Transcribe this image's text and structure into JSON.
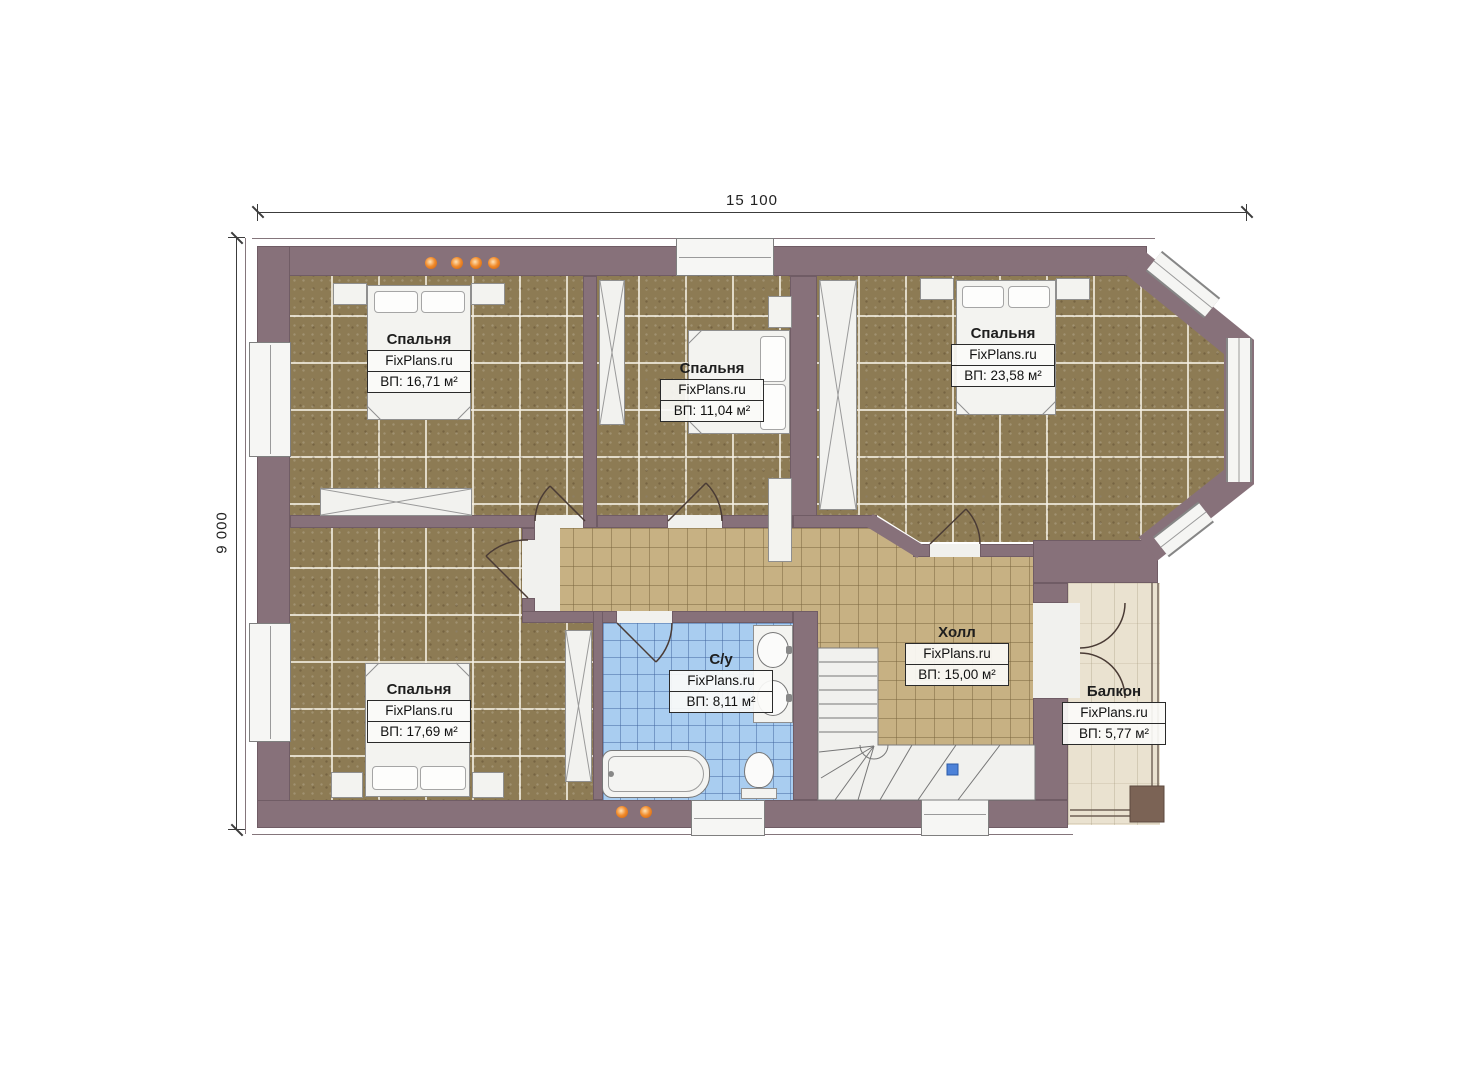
{
  "dimensions": {
    "width": "15 100",
    "height": "9 000"
  },
  "watermark": "FixPlans.ru",
  "rooms": [
    {
      "key": "bedroom-1",
      "name": "Спальня",
      "area": "ВП: 16,71 м²"
    },
    {
      "key": "bedroom-2",
      "name": "Спальня",
      "area": "ВП: 11,04 м²"
    },
    {
      "key": "bedroom-3",
      "name": "Спальня",
      "area": "ВП: 23,58 м²"
    },
    {
      "key": "bedroom-4",
      "name": "Спальня",
      "area": "ВП: 17,69 м²"
    },
    {
      "key": "bathroom",
      "name": "С/у",
      "area": "ВП: 8,11 м²"
    },
    {
      "key": "hall",
      "name": "Холл",
      "area": "ВП: 15,00 м²"
    },
    {
      "key": "balcony",
      "name": "Балкон",
      "area": "ВП: 5,77 м²"
    }
  ],
  "colors": {
    "wall": "#87717a",
    "bedroom_floor": "#8d7b54",
    "hall_floor": "#c7b183",
    "bath_floor": "#a9cdf0",
    "balcony_floor": "#eae2d0",
    "accent_dot": "#e87a22",
    "stair_marker": "#4d82d8"
  }
}
